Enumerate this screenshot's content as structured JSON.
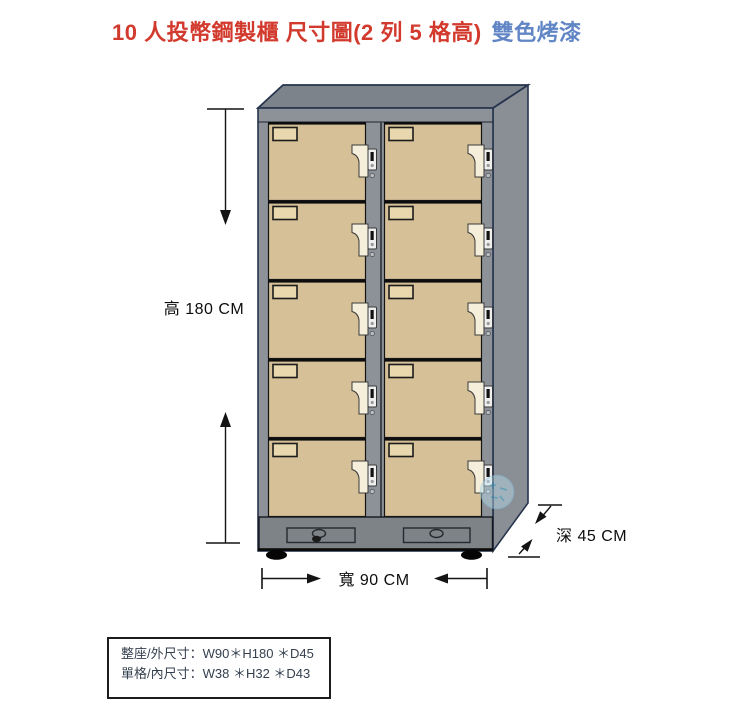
{
  "title": {
    "main": "10 人投幣鋼製櫃 尺寸圖(2 列 5 格高)",
    "suffix": "雙色烤漆",
    "main_color": "#d23a2e",
    "suffix_color": "#6286c5"
  },
  "dimensions": {
    "height_label": "高 180 CM",
    "width_label": "寬 90 CM",
    "depth_label": "深 45 CM"
  },
  "spec_box": {
    "line1": "整座/外尺寸：W90＊H180 ＊D45",
    "line2": "單格/內尺寸：W38 ＊H32 ＊D43"
  },
  "cabinet": {
    "columns": 2,
    "rows": 5,
    "total_compartments": 10,
    "door_color": "#d5c097",
    "frame_color": "#8d9298",
    "handle_color": "#f4eeda",
    "outline_color": "#26344e"
  }
}
